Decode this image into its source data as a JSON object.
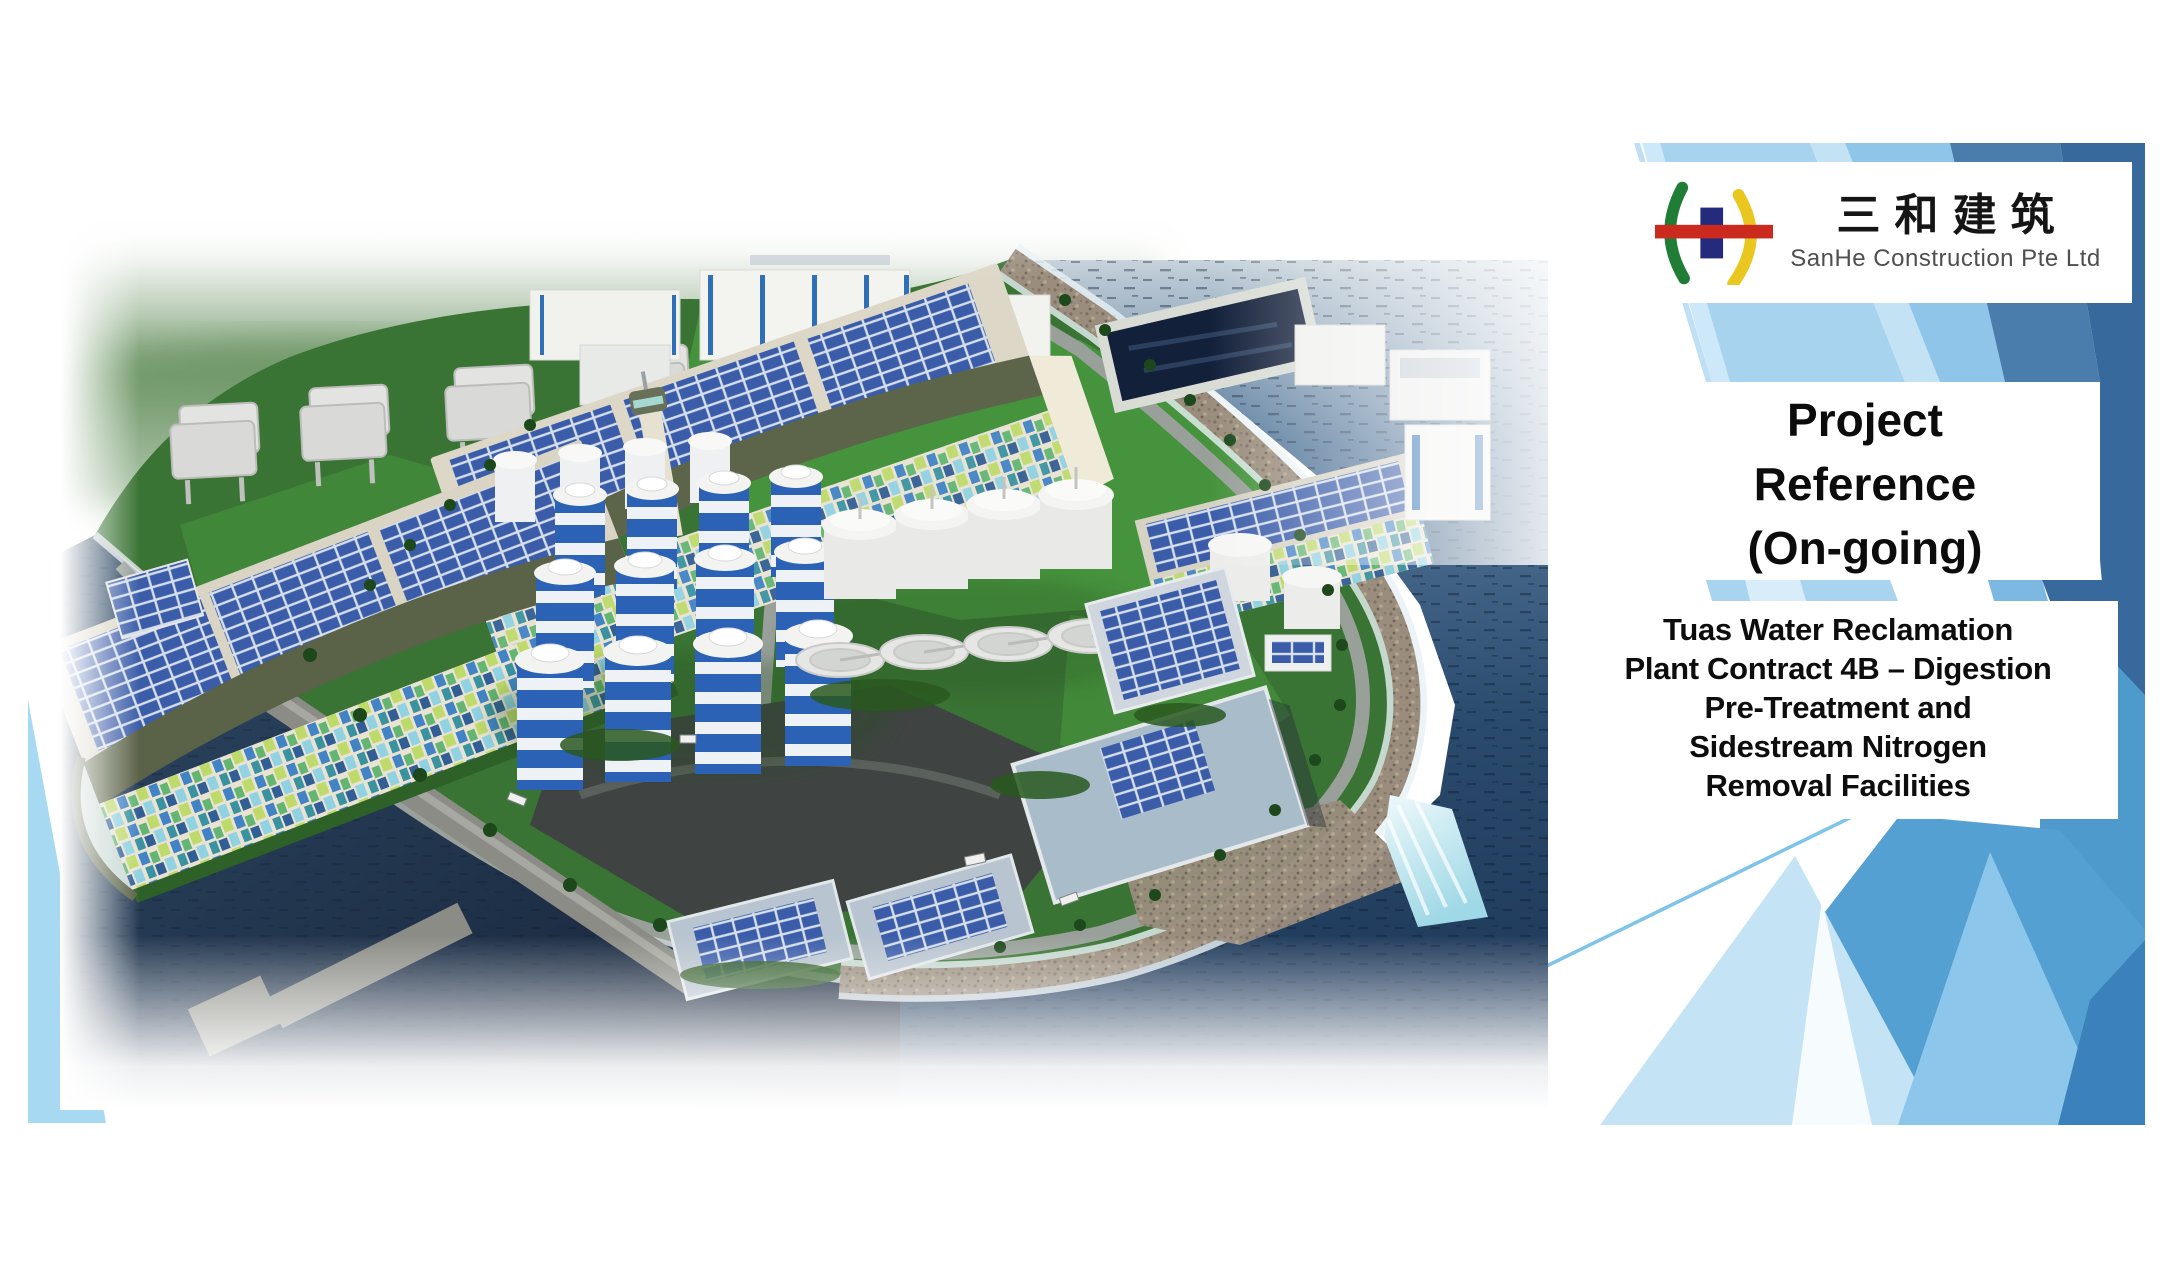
{
  "slide": {
    "logo": {
      "chinese_name": "三和建筑",
      "company_name": "SanHe Construction Pte Ltd"
    },
    "title": "Project\nReference\n(On-going)",
    "body": "Tuas Water Reclamation\nPlant Contract 4B – Digestion\nPre-Treatment and\nSidestream Nitrogen\nRemoval Facilities",
    "colors": {
      "deco_dark_blue": "#38699c",
      "deco_steel_blue": "#4a7dab",
      "deco_medium_blue": "#54a0d2",
      "deco_light_blue": "#8cc6ea",
      "deco_pale_blue": "#c4e3f5",
      "deco_corner_blue": "#a7d9f2",
      "logo_green": "#1f7d35",
      "logo_navy": "#252b7c",
      "logo_yellow": "#e9c71f",
      "logo_red": "#cb2a1f",
      "title_text": "#0c0c0c",
      "body_text": "#0d0d0d"
    }
  }
}
